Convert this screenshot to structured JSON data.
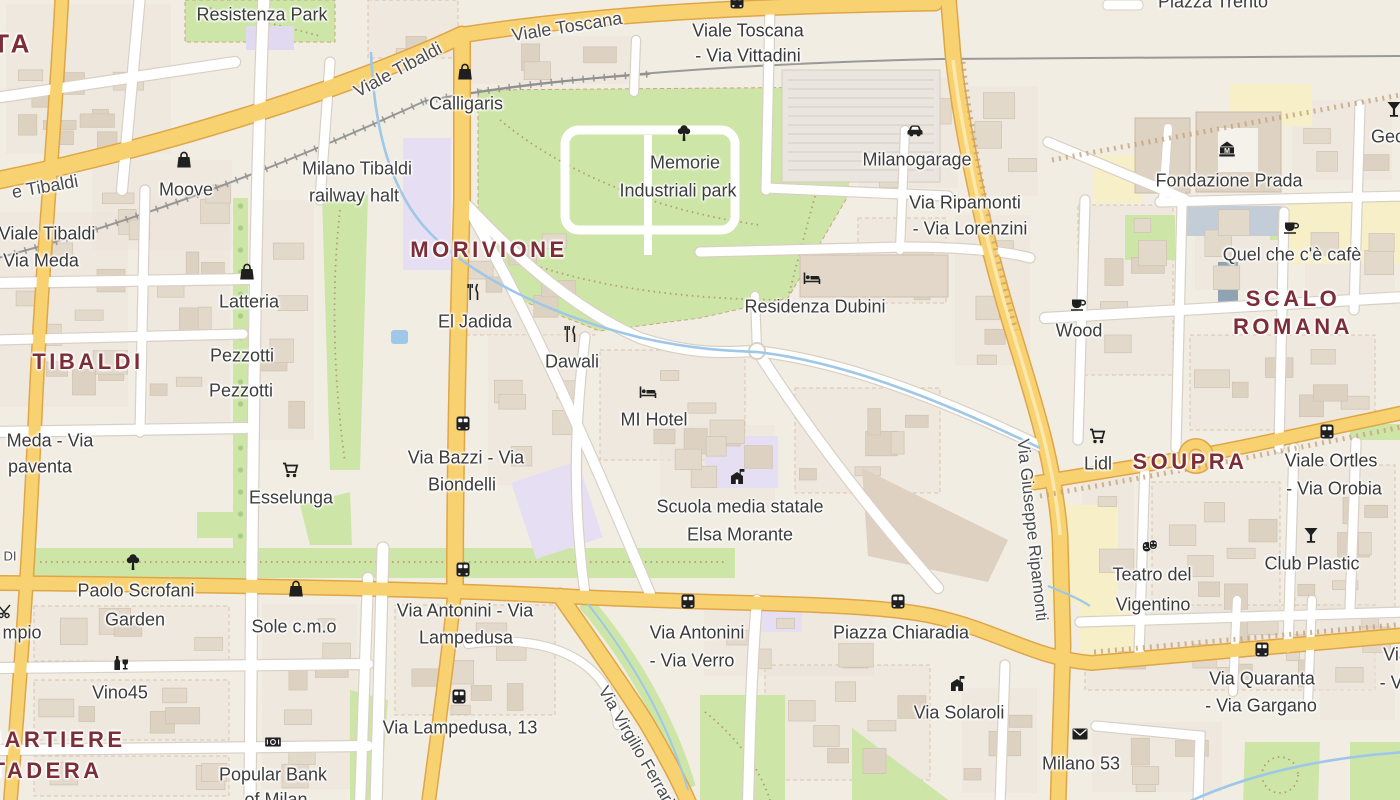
{
  "map": {
    "colors": {
      "land": "#f1ede3",
      "block": "#ece4da",
      "building": "#e3d9cb",
      "park_green": "#cde6a7",
      "water_blue": "#9fc7e8",
      "major_road": "#f8d271",
      "major_road_border": "#dfa648",
      "minor_road": "#ffffff",
      "minor_road_border": "#d9d0c5",
      "railway": "#8f8f8f",
      "district_text": "#7d2d37",
      "poi_text": "#3d3d3d",
      "school_area": "#e6def2",
      "commercial_area": "#f7efc8"
    },
    "districts": [
      {
        "t": "TA",
        "x": 13,
        "y": 44,
        "s": 26
      },
      {
        "t": "TIBALDI",
        "x": 88,
        "y": 362,
        "s": 22
      },
      {
        "t": "MORIVIONE",
        "x": 489,
        "y": 250,
        "s": 22
      },
      {
        "t": "SCALO",
        "x": 1293,
        "y": 299,
        "s": 22
      },
      {
        "t": "ROMANA",
        "x": 1293,
        "y": 327,
        "s": 22
      },
      {
        "t": "SOUPRA",
        "x": 1190,
        "y": 462,
        "s": 22
      },
      {
        "t": "QUARTIERE",
        "x": 45,
        "y": 740,
        "s": 22
      },
      {
        "t": "STADERA",
        "x": 38,
        "y": 771,
        "s": 22
      }
    ],
    "road_labels": [
      {
        "t": "Viale Toscana",
        "x": 567,
        "y": 27,
        "s": 18,
        "r": -9
      },
      {
        "t": "Viale Tibaldi",
        "x": 398,
        "y": 70,
        "s": 18,
        "r": -28
      },
      {
        "t": "e Tibaldi",
        "x": 45,
        "y": 187,
        "s": 18,
        "r": -10
      },
      {
        "t": "Via Giuseppe Ripamonti",
        "x": 1032,
        "y": 530,
        "s": 17,
        "r": 84
      },
      {
        "t": "Via Virgilio Ferrari",
        "x": 636,
        "y": 746,
        "s": 17,
        "r": 60
      },
      {
        "t": "DI",
        "x": 10,
        "y": 556,
        "s": 13,
        "r": 0
      }
    ],
    "transit_stops": [
      {
        "icon": {
          "type": "bus",
          "x": 737,
          "y": 2
        },
        "lines": [
          {
            "t": "Viale Toscana",
            "x": 748,
            "y": 31
          },
          {
            "t": "- Via Vittadini",
            "x": 748,
            "y": 56
          }
        ]
      },
      {
        "icon": null,
        "lines": [
          {
            "t": "Via Ripamonti",
            "x": 965,
            "y": 203
          },
          {
            "t": "- Via Lorenzini",
            "x": 970,
            "y": 229
          }
        ]
      },
      {
        "icon": null,
        "lines": [
          {
            "t": "Viale Tibaldi",
            "x": 47,
            "y": 234
          },
          {
            "t": "Via Meda",
            "x": 41,
            "y": 261
          }
        ]
      },
      {
        "icon": null,
        "lines": [
          {
            "t": "Meda - Via",
            "x": 50,
            "y": 441
          },
          {
            "t": "paventa",
            "x": 40,
            "y": 467
          }
        ]
      },
      {
        "icon": {
          "type": "bus",
          "x": 463,
          "y": 424
        },
        "lines": [
          {
            "t": "Via Bazzi - Via",
            "x": 466,
            "y": 458
          },
          {
            "t": "Biondelli",
            "x": 462,
            "y": 485
          }
        ]
      },
      {
        "icon": {
          "type": "bus",
          "x": 463,
          "y": 570
        },
        "lines": [
          {
            "t": "Via Antonini - Via",
            "x": 465,
            "y": 611
          },
          {
            "t": "Lampedusa",
            "x": 466,
            "y": 638
          }
        ]
      },
      {
        "icon": {
          "type": "bus",
          "x": 459,
          "y": 697
        },
        "lines": [
          {
            "t": "Via Lampedusa, 13",
            "x": 460,
            "y": 728
          }
        ]
      },
      {
        "icon": {
          "type": "bus",
          "x": 688,
          "y": 602
        },
        "lines": [
          {
            "t": "Via Antonini",
            "x": 697,
            "y": 633
          },
          {
            "t": "- Via Verro",
            "x": 692,
            "y": 661
          }
        ]
      },
      {
        "icon": {
          "type": "bus",
          "x": 898,
          "y": 602
        },
        "lines": [
          {
            "t": "Piazza Chiaradia",
            "x": 901,
            "y": 633
          }
        ]
      },
      {
        "icon": {
          "type": "bus",
          "x": 1327,
          "y": 432
        },
        "lines": [
          {
            "t": "Viale Ortles",
            "x": 1331,
            "y": 461
          },
          {
            "t": "- Via Orobia",
            "x": 1334,
            "y": 489
          }
        ]
      },
      {
        "icon": {
          "type": "bus",
          "x": 1262,
          "y": 650
        },
        "lines": [
          {
            "t": "Via Quaranta",
            "x": 1262,
            "y": 679
          },
          {
            "t": "- Via Gargano",
            "x": 1261,
            "y": 706
          }
        ]
      },
      {
        "icon": null,
        "lines": [
          {
            "t": "Via",
            "x": 1396,
            "y": 655
          },
          {
            "t": "- Via",
            "x": 1398,
            "y": 683
          }
        ]
      }
    ],
    "pois": [
      {
        "icon": {
          "type": "bag",
          "x": 184,
          "y": 160
        },
        "lines": [
          {
            "t": "Moove",
            "x": 186,
            "y": 190
          }
        ]
      },
      {
        "icon": {
          "type": "bag",
          "x": 465,
          "y": 72
        },
        "lines": [
          {
            "t": "Calligaris",
            "x": 466,
            "y": 104
          }
        ]
      },
      {
        "icon": {
          "type": "bag",
          "x": 247,
          "y": 272
        },
        "lines": [
          {
            "t": "Latteria",
            "x": 249,
            "y": 302
          }
        ]
      },
      {
        "icon": null,
        "lines": [
          {
            "t": "Pezzotti",
            "x": 242,
            "y": 356
          }
        ]
      },
      {
        "icon": null,
        "lines": [
          {
            "t": "Pezzotti",
            "x": 241,
            "y": 391
          }
        ]
      },
      {
        "icon": null,
        "lines": [
          {
            "t": "Resistenza Park",
            "x": 262,
            "y": 15
          }
        ]
      },
      {
        "icon": null,
        "lines": [
          {
            "t": "Milano Tibaldi",
            "x": 357,
            "y": 169
          },
          {
            "t": "railway halt",
            "x": 354,
            "y": 196
          }
        ]
      },
      {
        "icon": {
          "type": "tree",
          "x": 684,
          "y": 133
        },
        "lines": [
          {
            "t": "Memorie",
            "x": 685,
            "y": 163
          },
          {
            "t": "Industriali park",
            "x": 678,
            "y": 191
          }
        ]
      },
      {
        "icon": {
          "type": "car",
          "x": 915,
          "y": 130
        },
        "lines": [
          {
            "t": "Milanogarage",
            "x": 917,
            "y": 160
          }
        ]
      },
      {
        "icon": null,
        "lines": [
          {
            "t": "Piazza Trento",
            "x": 1213,
            "y": 2
          }
        ]
      },
      {
        "icon": {
          "type": "museum",
          "x": 1227,
          "y": 149
        },
        "lines": [
          {
            "t": "Fondazione Prada",
            "x": 1229,
            "y": 181
          }
        ]
      },
      {
        "icon": {
          "type": "cocktail",
          "x": 1394,
          "y": 109
        },
        "lines": [
          {
            "t": "Geck",
            "x": 1392,
            "y": 137
          }
        ]
      },
      {
        "icon": {
          "type": "cafe",
          "x": 1291,
          "y": 226
        },
        "lines": [
          {
            "t": "Quel che c'è cafè",
            "x": 1292,
            "y": 255
          }
        ]
      },
      {
        "icon": {
          "type": "cafe",
          "x": 1078,
          "y": 303
        },
        "lines": [
          {
            "t": "Wood",
            "x": 1079,
            "y": 331
          }
        ]
      },
      {
        "icon": {
          "type": "restaurant",
          "x": 474,
          "y": 292
        },
        "lines": [
          {
            "t": "El Jadida",
            "x": 475,
            "y": 322
          }
        ]
      },
      {
        "icon": {
          "type": "restaurant",
          "x": 571,
          "y": 334
        },
        "lines": [
          {
            "t": "Dawali",
            "x": 572,
            "y": 362
          }
        ]
      },
      {
        "icon": {
          "type": "bed",
          "x": 648,
          "y": 392
        },
        "lines": [
          {
            "t": "MI Hotel",
            "x": 654,
            "y": 420
          }
        ]
      },
      {
        "icon": {
          "type": "bed",
          "x": 812,
          "y": 278
        },
        "lines": [
          {
            "t": "Residenza Dubini",
            "x": 815,
            "y": 307
          }
        ]
      },
      {
        "icon": {
          "type": "school",
          "x": 737,
          "y": 477
        },
        "lines": [
          {
            "t": "Scuola media statale",
            "x": 740,
            "y": 507
          },
          {
            "t": "Elsa Morante",
            "x": 740,
            "y": 535
          }
        ]
      },
      {
        "icon": {
          "type": "cart",
          "x": 290,
          "y": 470
        },
        "lines": [
          {
            "t": "Esselunga",
            "x": 291,
            "y": 498
          }
        ]
      },
      {
        "icon": {
          "type": "tree",
          "x": 133,
          "y": 562
        },
        "lines": [
          {
            "t": "Paolo Scrofani",
            "x": 136,
            "y": 591
          },
          {
            "t": "Garden",
            "x": 135,
            "y": 620
          }
        ]
      },
      {
        "icon": {
          "type": "bag",
          "x": 296,
          "y": 589
        },
        "lines": [
          {
            "t": "Sole c.m.o",
            "x": 294,
            "y": 627
          }
        ]
      },
      {
        "icon": {
          "type": "wine",
          "x": 121,
          "y": 663
        },
        "lines": [
          {
            "t": "Vino45",
            "x": 120,
            "y": 693
          }
        ]
      },
      {
        "icon": {
          "type": "bank",
          "x": 273,
          "y": 742
        },
        "lines": [
          {
            "t": "Popular Bank",
            "x": 273,
            "y": 775
          },
          {
            "t": "of Milan",
            "x": 276,
            "y": 800
          }
        ]
      },
      {
        "icon": {
          "type": "cart",
          "x": 1097,
          "y": 436
        },
        "lines": [
          {
            "t": "Lidl",
            "x": 1098,
            "y": 464
          }
        ]
      },
      {
        "icon": {
          "type": "cocktail",
          "x": 1311,
          "y": 535
        },
        "lines": [
          {
            "t": "Club Plastic",
            "x": 1312,
            "y": 564
          }
        ]
      },
      {
        "icon": {
          "type": "masks",
          "x": 1150,
          "y": 546
        },
        "lines": [
          {
            "t": "Teatro del",
            "x": 1152,
            "y": 575
          },
          {
            "t": "Vigentino",
            "x": 1153,
            "y": 605
          }
        ]
      },
      {
        "icon": {
          "type": "school",
          "x": 957,
          "y": 684
        },
        "lines": [
          {
            "t": "Via Solaroli",
            "x": 959,
            "y": 713
          }
        ]
      },
      {
        "icon": {
          "type": "mail",
          "x": 1080,
          "y": 734
        },
        "lines": [
          {
            "t": "Milano 53",
            "x": 1081,
            "y": 764
          }
        ]
      },
      {
        "icon": {
          "type": "scissors",
          "x": 6,
          "y": 611
        },
        "lines": []
      },
      {
        "icon": null,
        "lines": [
          {
            "t": "mpio",
            "x": 22,
            "y": 633
          }
        ]
      }
    ]
  }
}
